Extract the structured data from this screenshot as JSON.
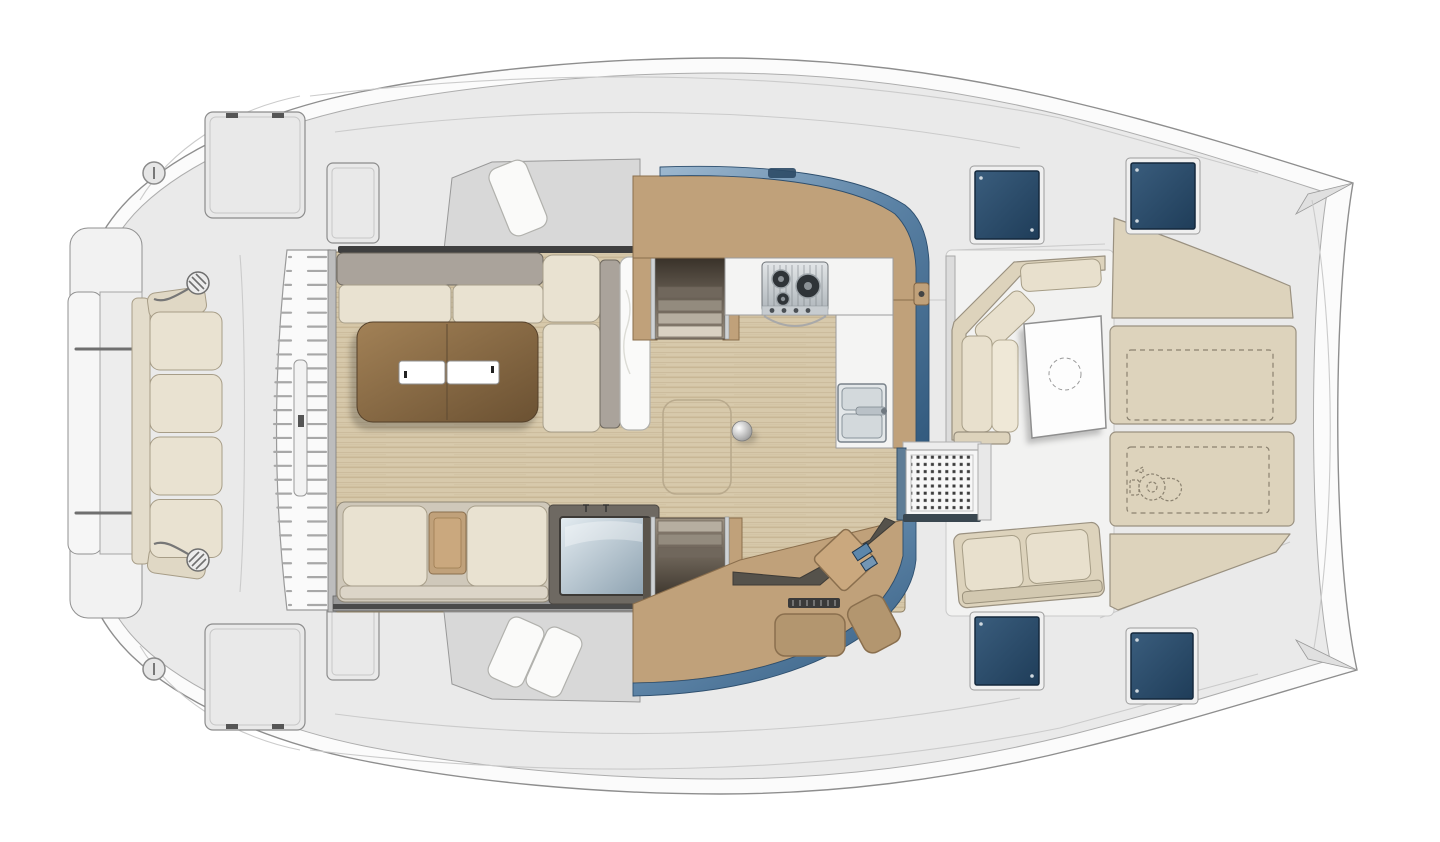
{
  "meta": {
    "width": 1440,
    "height": 842,
    "description": "Catamaran yacht main-deck floor plan, top-down architectural rendering, bow at left and twin stern tips at right"
  },
  "palette": {
    "bg": "#ffffff",
    "hull_fill": "#fbfbfb",
    "hull_stroke": "#8e8e8e",
    "deck_fill": "#eaeaea",
    "deck_seam": "#cbcbcb",
    "wall_gray": "#d8d8d8",
    "wood_light": "#d7c9ab",
    "wood_dark": "#c0ae8b",
    "tan": "#c0a17a",
    "tan_stroke": "#8a6e4c",
    "cream": "#e9e2d1",
    "cream_stroke": "#a89f8a",
    "taupe": "#aaa39b",
    "beige": "#ddd3bc",
    "beige_stroke": "#9a9180",
    "dash": "#8b8270",
    "blue_light": "#9db8cf",
    "blue_dark": "#31597d",
    "navy_light": "#3a5d7d",
    "navy_dark": "#1f3d59",
    "metal_light": "#e3e6e8",
    "metal_dark": "#aeb5ba",
    "screen_light": "#e4ecf1",
    "screen_dark": "#8ba0af",
    "table_wood_light": "#a28156",
    "table_wood_dark": "#6b5132",
    "mat_dot": "#3c3c3c",
    "stair_light": "#d9d1c2",
    "stair_dark": "#4d443a",
    "desk_dark": "#55524b"
  },
  "regions": {
    "bow": {
      "bench_cushions": 4,
      "deck_lockers": 2,
      "small_lockers": 2,
      "deck_ports": 2,
      "trampoline_slats": 26
    },
    "saloon": {
      "sofa_seat_cushions": 2,
      "coffee_table_trays": 2,
      "aft_bench_cushions": 2,
      "tv_screen": true,
      "mast_step_ball": true,
      "floor_hatch": true
    },
    "galley": {
      "stove_burners": 3,
      "sink_basins": 2,
      "port_stair_steps": 4,
      "starboard_stair_steps": 3
    },
    "cockpit": {
      "corner_bench_cushions": 3,
      "aft_bench_cushions": 2,
      "table_dashed_circle": true,
      "sunbed_panels": 4,
      "storage_dashed_outlines": 2,
      "windlass_dashed_outline": true,
      "deck_hatches": 4
    }
  }
}
